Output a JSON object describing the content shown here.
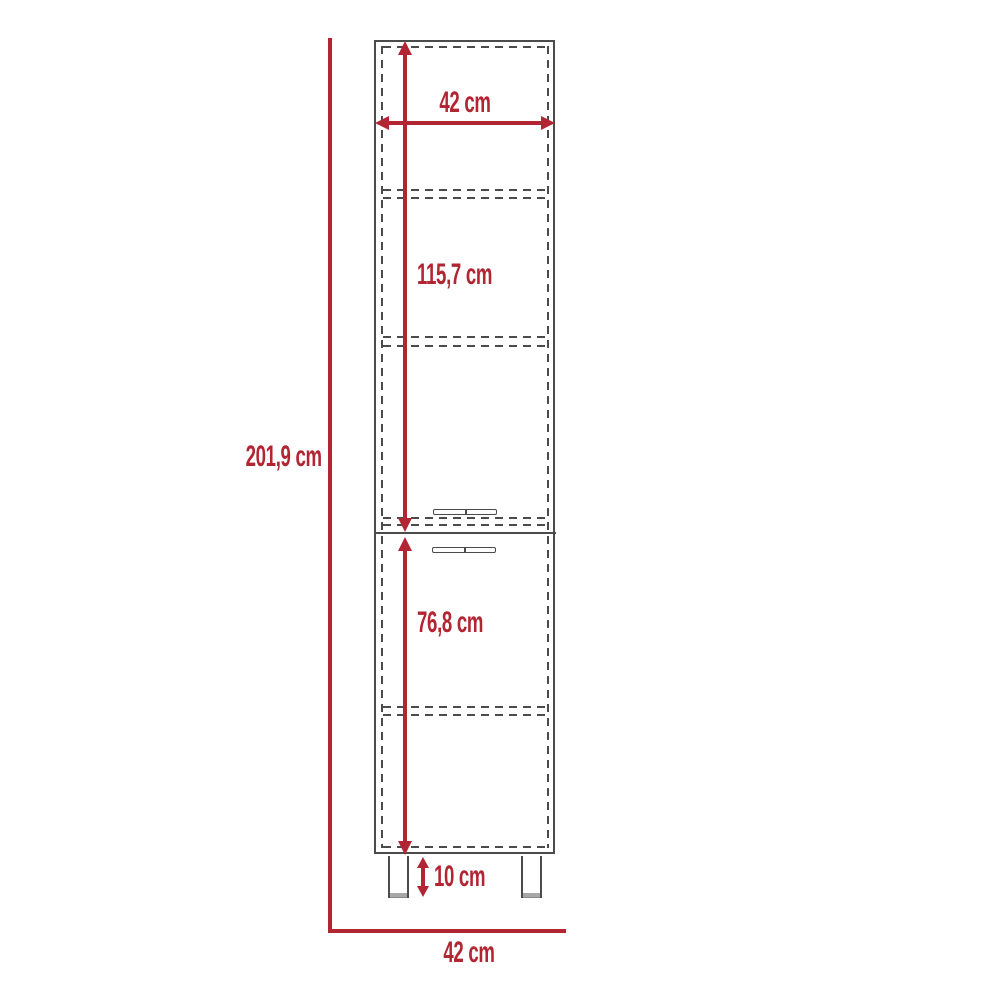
{
  "diagram": {
    "type": "furniture-dimension-drawing",
    "subject": "tall two-door pantry cabinet, front elevation with shelves, handles and legs",
    "unit": "cm",
    "labels": {
      "top_width": "42 cm",
      "upper_section_height": "115,7 cm",
      "total_height": "201,9 cm",
      "lower_section_height": "76,8 cm",
      "leg_height": "10 cm",
      "bottom_width": "42 cm"
    },
    "colors": {
      "dimension_red": "#b22533",
      "outline_gray": "#4b4b4b",
      "leg_cap_gray": "#a8a8a8",
      "background": "#ffffff"
    }
  }
}
